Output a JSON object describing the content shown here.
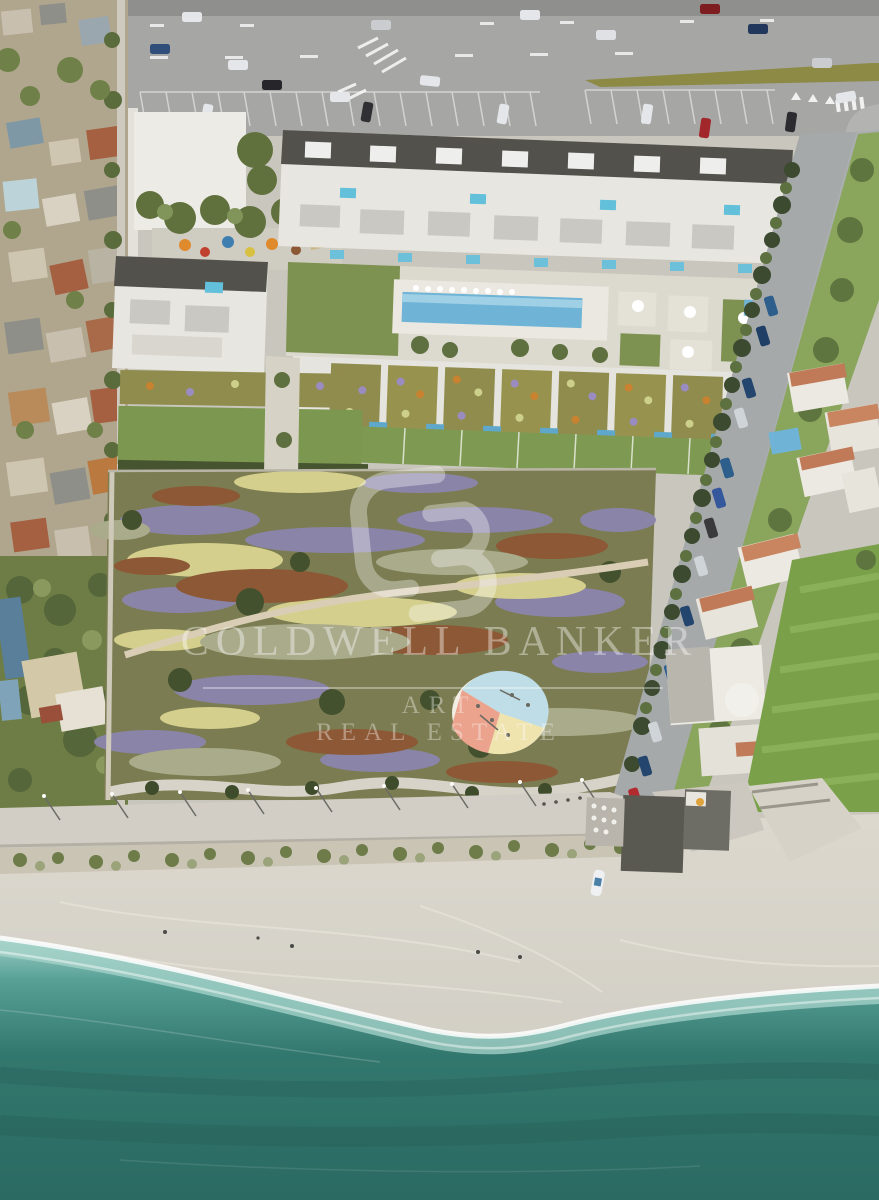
{
  "watermark": {
    "brand": "COLDWELL BANKER",
    "division_line1": "ART",
    "division_line2": "REAL ESTATE",
    "logo_icon": "coldwell-banker-cb-monogram"
  },
  "palette": {
    "sea_deep": "#2a6a62",
    "sea_mid": "#32776d",
    "sea_shallow": "#9fcfc6",
    "foam_white": "#ffffff",
    "beach_sand": "#d9d5cb",
    "promenade_gray": "#d2cec5",
    "meadow_olive": "#7b7c51",
    "flower_purple": "#8b85ad",
    "flower_yellow": "#d5cf8d",
    "flower_rust": "#8d5835",
    "lawn_green": "#7c9a4f",
    "building_white": "#e8e6e0",
    "roof_dark": "#52514b",
    "green_roof": "#8f8c4d",
    "pool_blue": "#6fb4d6",
    "road_asphalt": "#a6a6a4",
    "terracotta_roof": "#c07a58",
    "watermark_white": "rgba(255,255,255,0.38)"
  }
}
